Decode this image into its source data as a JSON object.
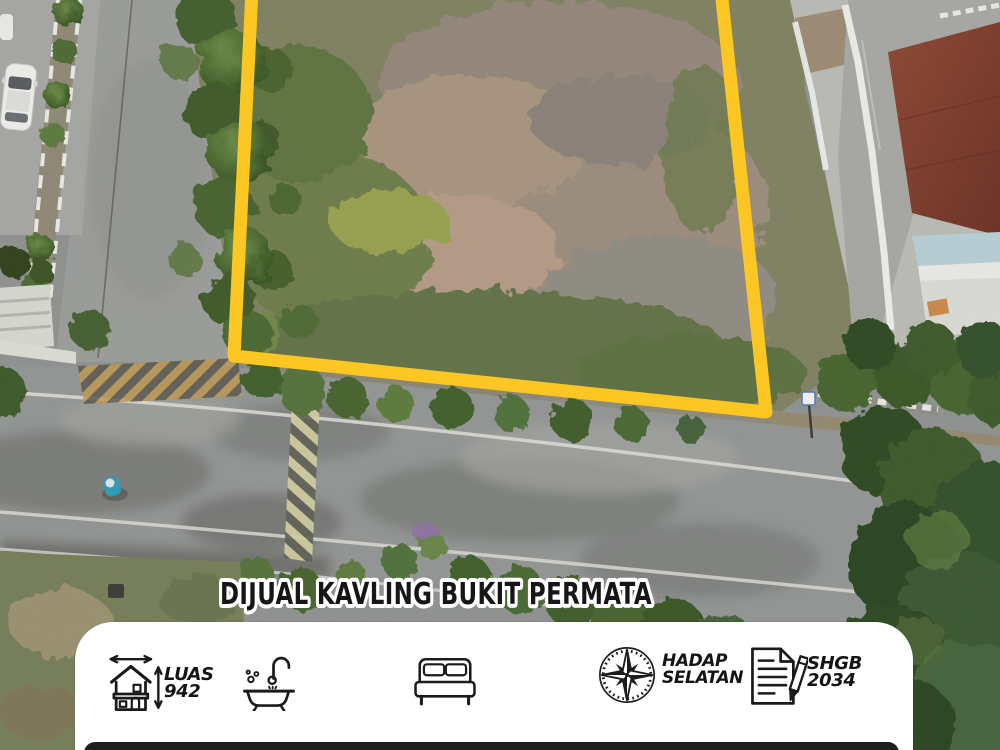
{
  "title": "DIJUAL KAVLING BUKIT PERMATA",
  "card": {
    "features": [
      {
        "icon": "house-measure-icon",
        "line1": "LUAS",
        "line2": "942"
      },
      {
        "icon": "bathtub-icon",
        "line1": "",
        "line2": ""
      },
      {
        "icon": "bed-icon",
        "line1": "",
        "line2": ""
      },
      {
        "icon": "compass-icon",
        "line1": "HADAP",
        "line2": "SELATAN"
      },
      {
        "icon": "deed-document-icon",
        "line1": "SHGB",
        "line2": "2034"
      }
    ]
  },
  "colors": {
    "plot_outline": "#FCC722",
    "title_fill": "#161616",
    "title_stroke": "#FFFFFF",
    "card_background": "#FFFFFF",
    "bottom_bar": "#1E1E1E"
  },
  "photo": {
    "type": "aerial-drone-photo",
    "visible_objects": [
      "vacant-land-plot-outlined-yellow",
      "residential-road",
      "white-parked-car",
      "motorcyclist",
      "red-roof-house",
      "trees-and-shrubs",
      "hazard-striped-road-markings"
    ]
  }
}
